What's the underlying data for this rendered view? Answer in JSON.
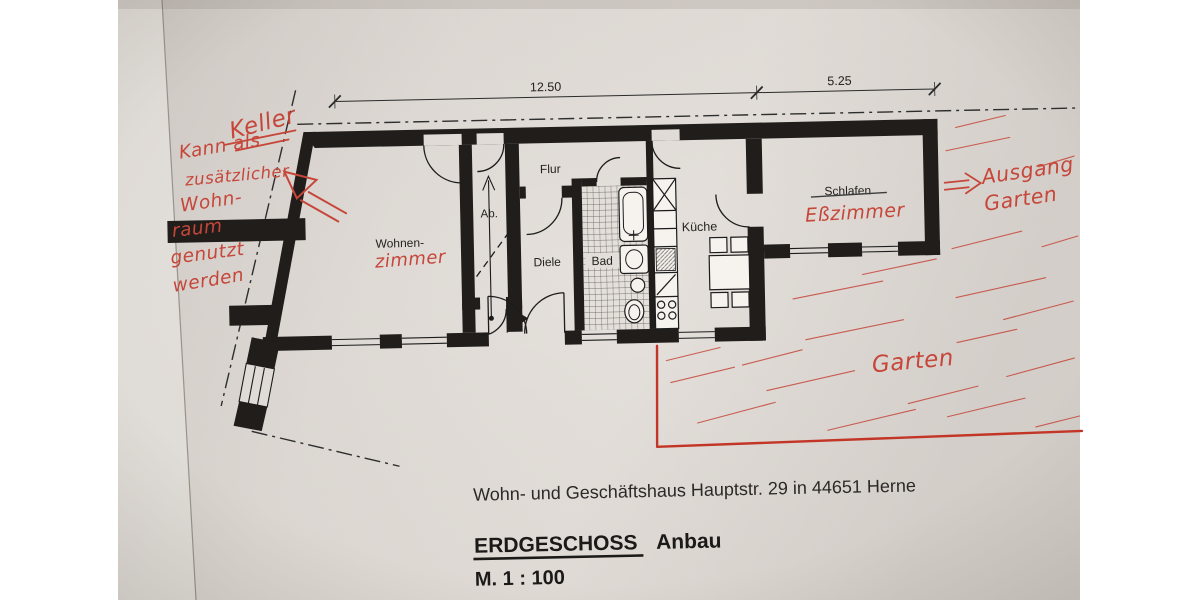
{
  "title_block": {
    "address": "Wohn- und Geschäftshaus  Hauptstr. 29 in 44651 Herne",
    "floor": "ERDGESCHOSS",
    "floor_suffix": "Anbau",
    "scale": "M. 1 : 100"
  },
  "dimension_labels": {
    "main": "12.50",
    "annex": "5.25"
  },
  "rooms": {
    "flur": {
      "label": "Flur"
    },
    "ab": {
      "label": "Ab."
    },
    "wohnen": {
      "label": "Wohnen-",
      "handwritten_suffix": "zimmer"
    },
    "diele": {
      "label": "Diele"
    },
    "bad": {
      "label": "Bad"
    },
    "kueche": {
      "label": "Küche"
    },
    "schlafen": {
      "label": "Schlafen",
      "struck_through": true,
      "handwritten_replacement": "Eßzimmer"
    }
  },
  "handwritten_notes": {
    "keller": "Keller",
    "note_lines": [
      "Kann als",
      "zusätzlicher",
      "Wohn-",
      "raum",
      "genutzt",
      "werden"
    ],
    "exit_line1": "Ausgang",
    "exit_line2": "Garten",
    "garden": "Garten"
  },
  "colors": {
    "ink_red": "#c6463a",
    "boundary_red": "#c23527",
    "walls": "#201d1a",
    "paper": "#e2ddd8"
  }
}
